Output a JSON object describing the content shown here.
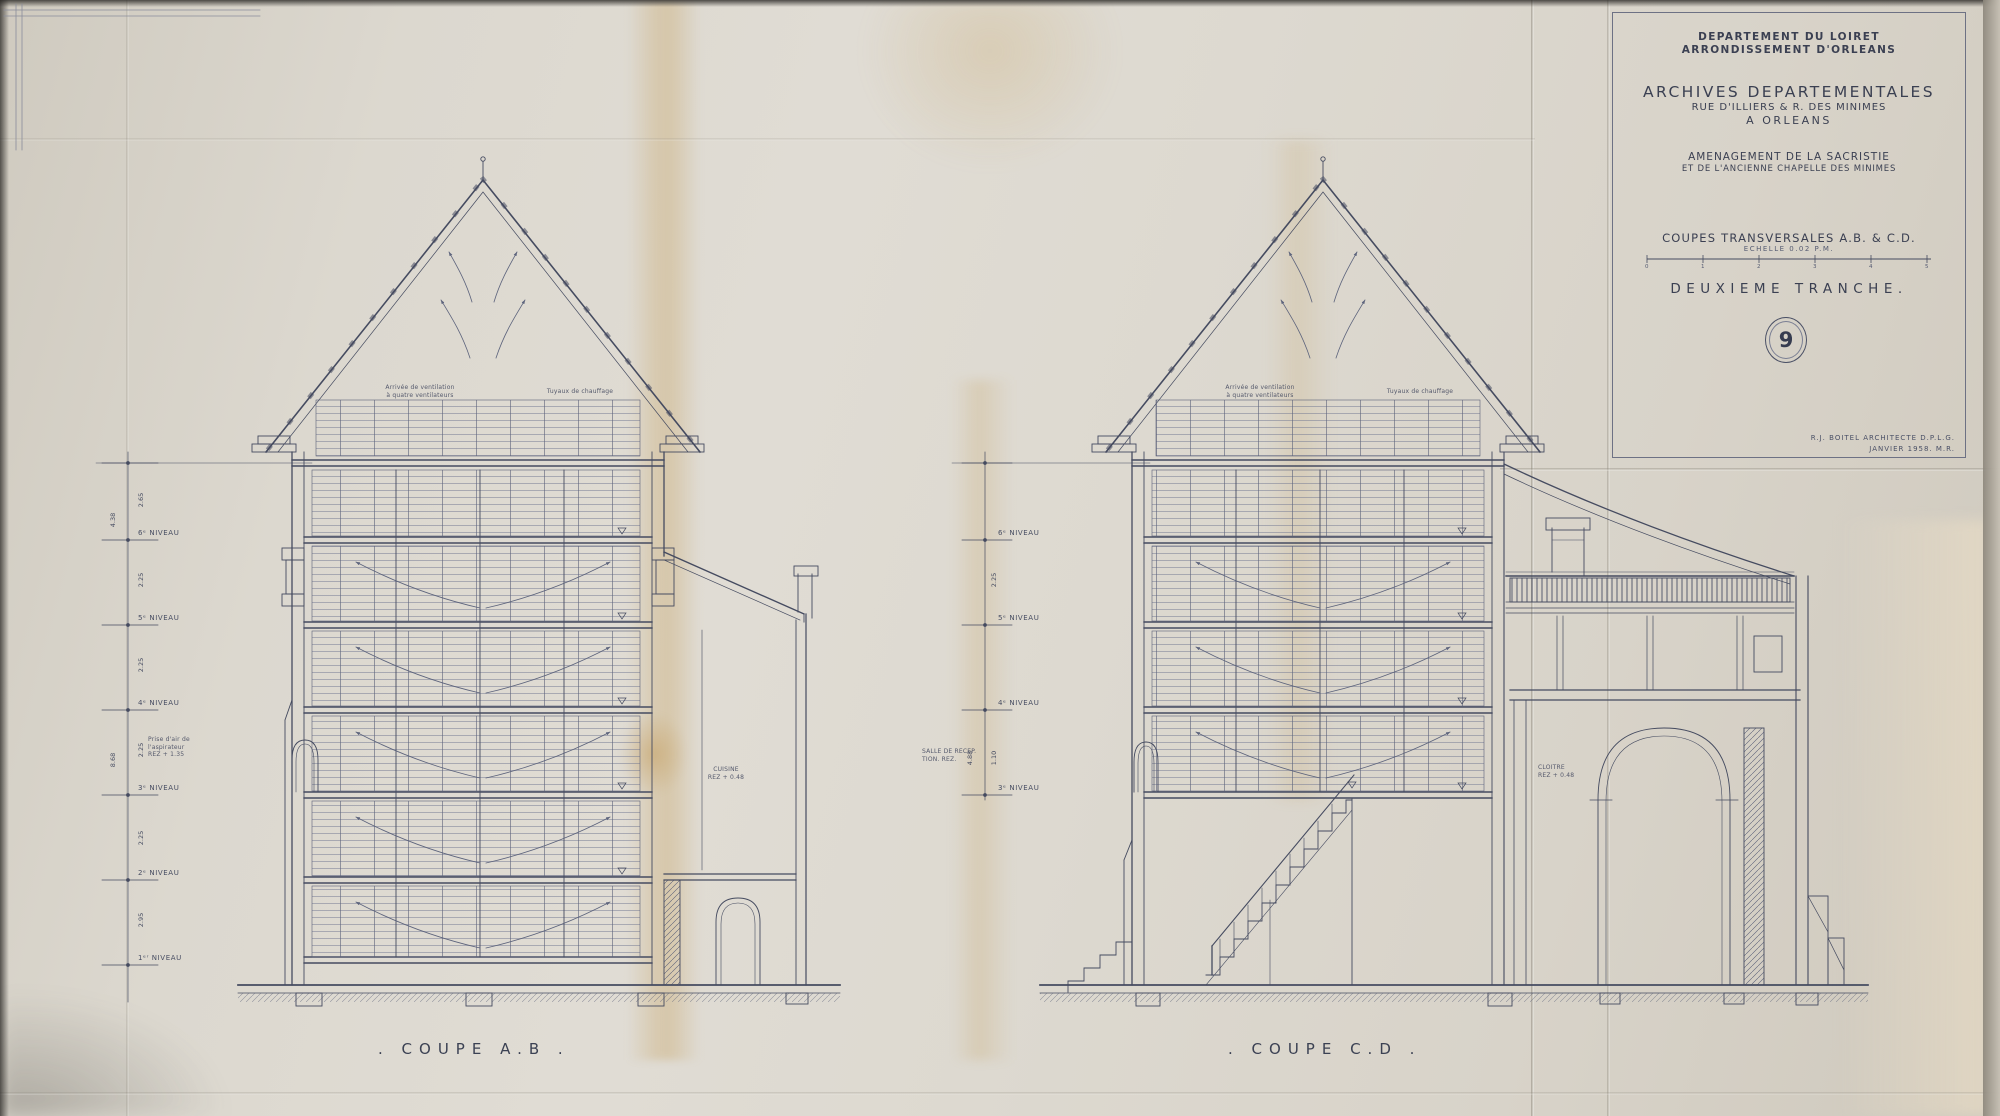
{
  "title_block": {
    "department": "DEPARTEMENT DU LOIRET",
    "arrondissement": "ARRONDISSEMENT D'ORLEANS",
    "main_title": "ARCHIVES DEPARTEMENTALES",
    "address_line": "RUE D'ILLIERS & R. DES MINIMES",
    "city_line": "A ORLEANS",
    "project_line1": "AMENAGEMENT DE LA SACRISTIE",
    "project_line2": "ET DE L'ANCIENNE CHAPELLE DES MINIMES",
    "drawing_title": "COUPES TRANSVERSALES A.B. & C.D.",
    "scale_label": "ECHELLE 0.02 P.M.",
    "scale_ticks": [
      "0",
      "1",
      "2",
      "3",
      "4",
      "5"
    ],
    "phase": "DEUXIEME TRANCHE.",
    "sheet_number": "9",
    "architect_line1": "R.J. BOITEL ARCHITECTE D.P.L.G.",
    "architect_line2": "JANVIER 1958. M.R."
  },
  "sections": {
    "left_label": ". COUPE A.B .",
    "right_label": ". COUPE C.D ."
  },
  "levels": [
    "6ᵉ NIVEAU",
    "5ᵉ NIVEAU",
    "4ᵉ NIVEAU",
    "3ᵉ NIVEAU",
    "2ᵉ NIVEAU",
    "1ᵉʳ NIVEAU"
  ],
  "dims_left": [
    "2.65",
    "2.25",
    "2.25",
    "2.25",
    "2.25",
    "2.95"
  ],
  "dims_left_cumul": [
    "4.38",
    "8.68"
  ],
  "dims_right": [
    "4.88",
    "1.10",
    "2.25"
  ],
  "notes": {
    "vent_line1": "Arrivée de ventilation",
    "vent_line2": "à quatre ventilateurs",
    "chauffage": "Tuyaux de chauffage",
    "prise_air_line1": "Prise d'air de",
    "prise_air_line2": "l'aspirateur",
    "prise_air_line3": "REZ + 1.35",
    "cuisine_line1": "CUISINE",
    "cuisine_line2": "REZ + 0.48",
    "salle_line1": "SALLE DE RECEP.",
    "salle_line2": "TION. REZ.",
    "cloitre_line1": "CLOITRE",
    "cloitre_line2": "REZ + 0.48"
  },
  "colors": {
    "ink": "#454b60",
    "ink_light": "#6a7086",
    "paper": "#dad6cc",
    "stain": "#c19648"
  }
}
